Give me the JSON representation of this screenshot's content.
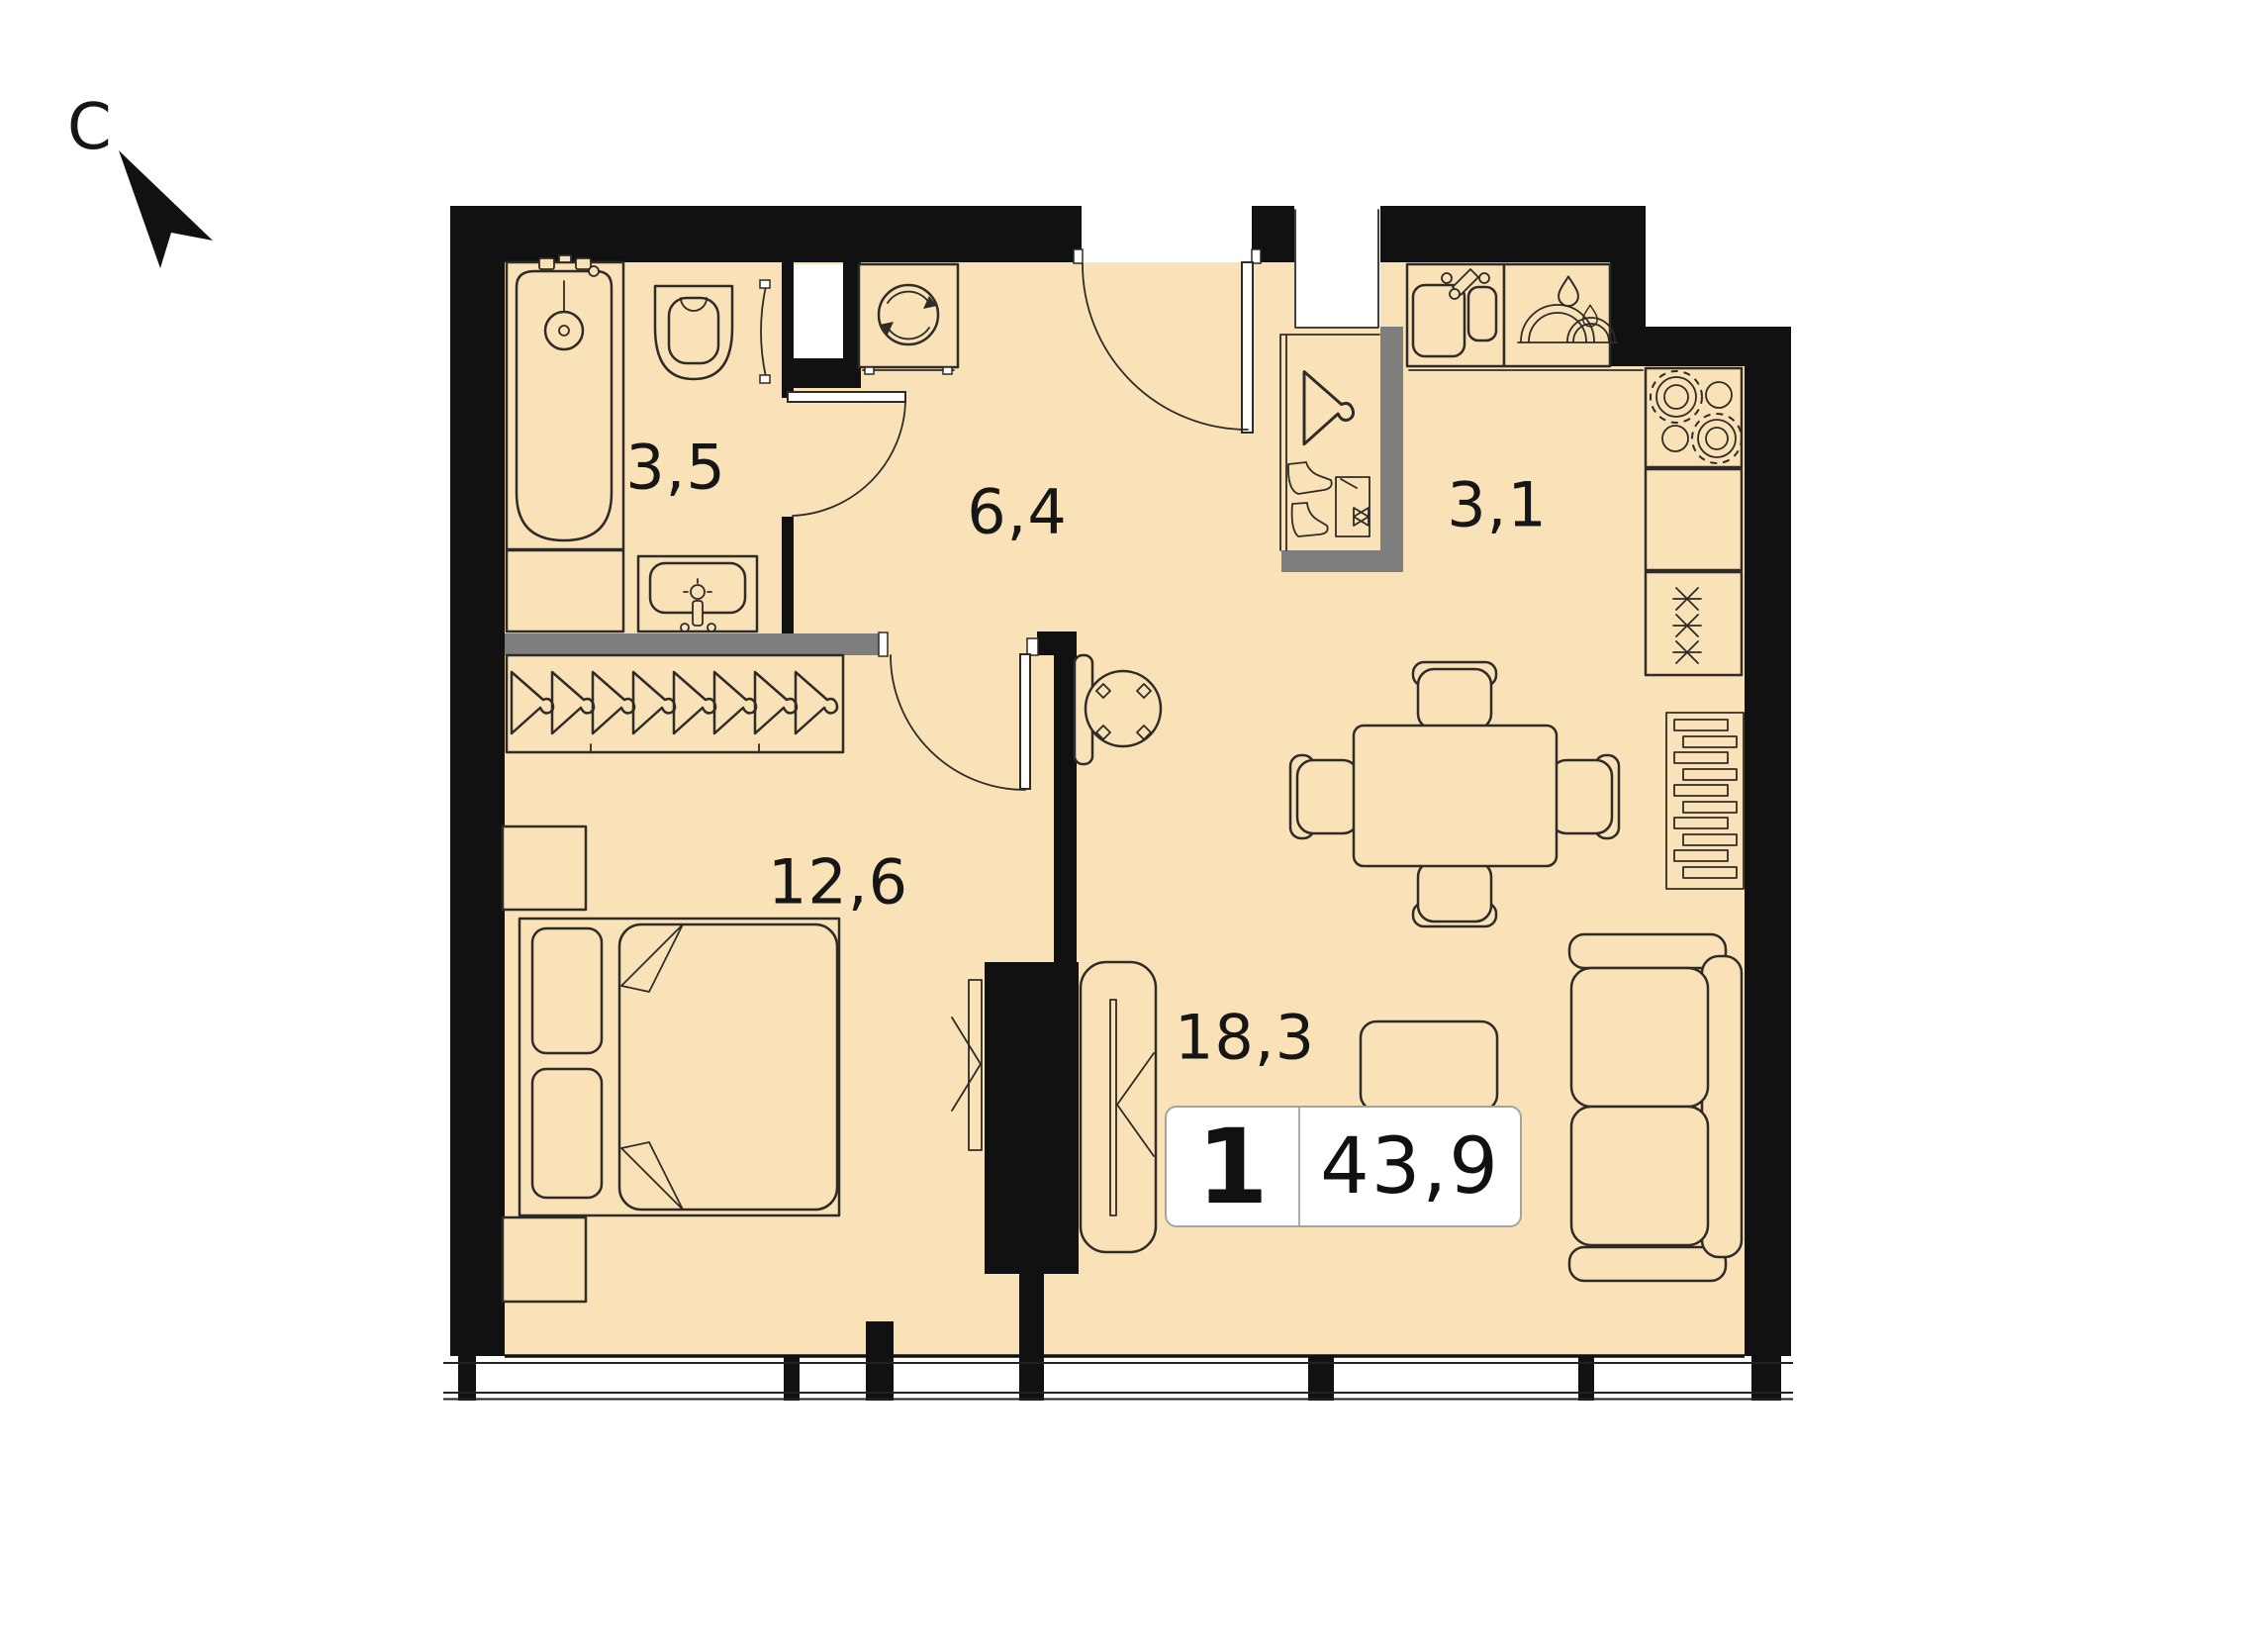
{
  "north_indicator": {
    "label": "С"
  },
  "rooms": [
    {
      "name": "bathroom",
      "area_label": "3,5"
    },
    {
      "name": "hallway",
      "area_label": "6,4"
    },
    {
      "name": "kitchen",
      "area_label": "3,1"
    },
    {
      "name": "bedroom",
      "area_label": "12,6"
    },
    {
      "name": "living-room",
      "area_label": "18,3"
    }
  ],
  "info_badge": {
    "rooms_count": "1",
    "total_area": "43,9"
  },
  "icons": [
    "north-arrow-icon",
    "bathtub",
    "toilet",
    "shower-screen",
    "washbasin",
    "washing-machine",
    "entrance-door",
    "bathroom-door",
    "bedroom-door",
    "hanger",
    "boots",
    "storage-box",
    "wardrobe-hangers",
    "bed",
    "pillow",
    "nightstand",
    "tv",
    "tv-stand",
    "round-table",
    "dining-table",
    "chair",
    "kitchen-sink",
    "dish-dryer",
    "cooktop",
    "fridge",
    "radiator",
    "sofa",
    "coffee-table",
    "window"
  ],
  "colors": {
    "floor": "#FAE2B8",
    "walls": "#111111",
    "partition": "#7E7E7E",
    "furniture_stroke": "#2F2B26",
    "background": "#FFFFFF",
    "badge_border": "#A3A3A3"
  }
}
